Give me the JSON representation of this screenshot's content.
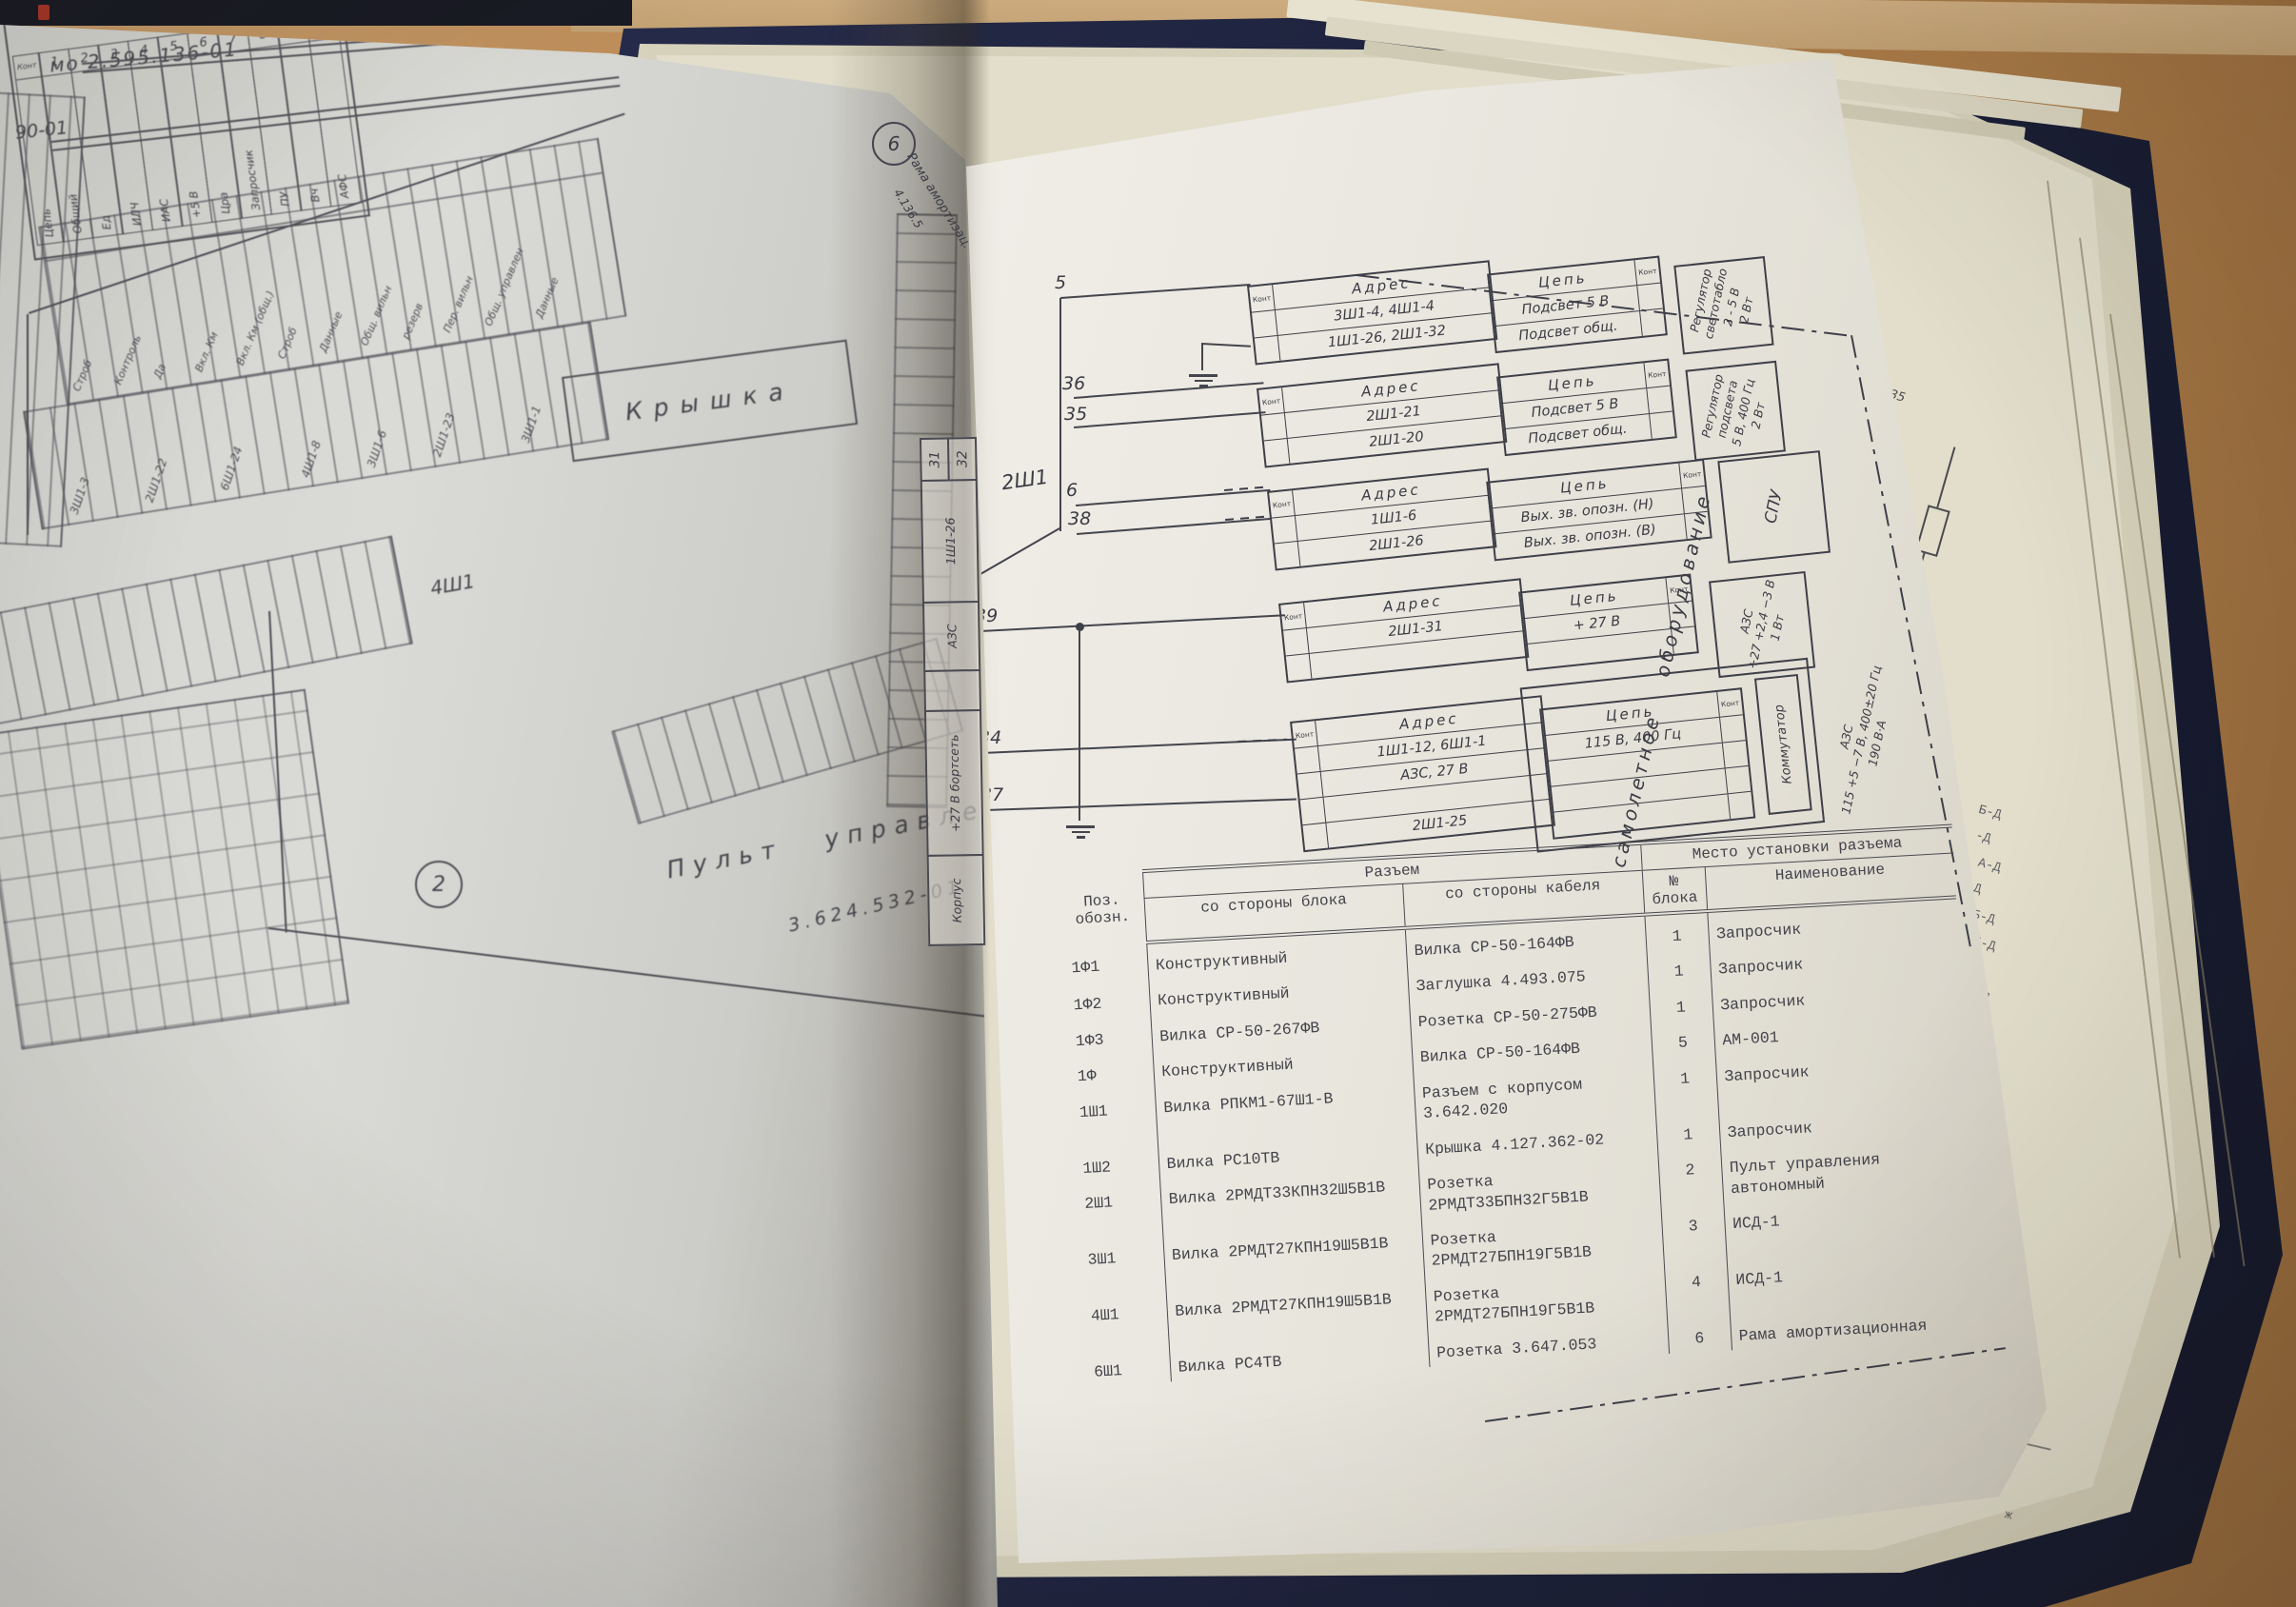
{
  "scene": {
    "description": "Photograph of an open technical manual with wiring schematics and a connector table",
    "colors": {
      "cardboard": "#b5834e",
      "cover": "#1f2440",
      "left_paper": "#d4d5d1",
      "right_paper": "#eae8e0",
      "under_paper": "#e2decb",
      "ink": "#3b3b44"
    }
  },
  "left_page": {
    "doc_number": "мо  2.595.136-01",
    "doc_number2": "90-01",
    "kontrol": {
      "title": "Контроль",
      "connector": "1Ш2",
      "kont": "Конт",
      "tsep": "Цепь",
      "pins": [
        {
          "n": "1",
          "label": "Общий"
        },
        {
          "n": "2",
          "label": "Ед"
        },
        {
          "n": "3",
          "label": "ИЛЧ"
        },
        {
          "n": "4",
          "label": "ИАС"
        },
        {
          "n": "5",
          "label": "+5 В"
        },
        {
          "n": "6",
          "label": "Цра"
        },
        {
          "n": "7",
          "label": "Запросчик"
        },
        {
          "n": "8",
          "label": "ПУ"
        },
        {
          "n": "9",
          "label": "Вч"
        },
        {
          "n": "10",
          "label": "АФС"
        }
      ]
    },
    "kryshka": "Крышка",
    "connector_4sh1": "4Ш1",
    "strip_labels": [
      "Строб",
      "Контроль",
      "Да",
      "Вкл. Км",
      "Вкл. Км (общ.)",
      "Строб",
      "Данные",
      "Общ. вильн",
      "резерв",
      "Пер. вильн",
      "Общ. управлен",
      "Данные"
    ],
    "strip_addresses": [
      "3Ш1-3",
      "2Ш1-22",
      "6Ш1-24",
      "4Ш1-8",
      "3Ш1-6",
      "2Ш1-23",
      "3Ш1-1"
    ],
    "callout_2": "2",
    "pult_title": "Пульт управления автономный",
    "pult_number": "3.624.532-01",
    "callout_6": "6",
    "rama_label": "Рама амортизац.",
    "rama_number": "4.136.5",
    "gutter_connector": {
      "name": "2Ш1",
      "pin_a": "31",
      "pin_b": "32",
      "cells": [
        "1Ш1-26",
        "АЗС",
        "+27 В бортсеть",
        "Корпус"
      ]
    }
  },
  "right_page": {
    "wire_labels": {
      "w5": "5",
      "w36": "36",
      "w35": "35",
      "w6": "6",
      "w38": "38",
      "w39": "39",
      "w34": "34",
      "w37": "37"
    },
    "blocks": [
      {
        "kont": "Конт",
        "adres": "Адрес",
        "tsep": "Цепь",
        "rows": [
          [
            "3Ш1-4, 4Ш1-4",
            "Подсвет 5 В"
          ],
          [
            "1Ш1-26, 2Ш1-32",
            "Подсвет общ."
          ]
        ],
        "equipment": [
          "Регулятор",
          "светотабло",
          "2 - 5 В",
          "2 Вт"
        ]
      },
      {
        "kont": "Конт",
        "adres": "Адрес",
        "tsep": "Цепь",
        "rows": [
          [
            "2Ш1-21",
            "Подсвет 5 В"
          ],
          [
            "2Ш1-20",
            "Подсвет общ."
          ]
        ],
        "equipment": [
          "Регулятор",
          "подсвета",
          "5 В, 400 Гц",
          "2 Вт"
        ]
      },
      {
        "kont": "Конт",
        "adres": "Адрес",
        "tsep": "Цепь",
        "rows": [
          [
            "1Ш1-6",
            "Вых. зв. опозн. (Н)"
          ],
          [
            "2Ш1-26",
            "Вых. зв. опозн. (В)"
          ]
        ],
        "equipment": [
          "СПУ"
        ]
      },
      {
        "kont": "Конт",
        "adres": "Адрес",
        "tsep": "Цепь",
        "rows": [
          [
            "2Ш1-31",
            "+ 27 В"
          ]
        ],
        "equipment": [
          "АЗС",
          "+27 +2,4 −3 В",
          "1 Вт"
        ]
      },
      {
        "kont": "Конт",
        "adres": "Адрес",
        "tsep": "Цепь",
        "rows": [
          [
            "1Ш1-12, 6Ш1-1",
            "115 В, 400 Гц"
          ],
          [
            "АЗС,  27 В",
            ""
          ],
          [
            "2Ш1-25",
            ""
          ]
        ],
        "equipment": [
          "Коммутатор"
        ],
        "equipment2": [
          "АЗС",
          "115 +5 −7 В, 400±20 Гц",
          "190 В·А"
        ]
      }
    ],
    "boundary_label": "самолетное  оборудование",
    "table": {
      "h_pos": "Поз. обозн.",
      "h_razem": "Разъем",
      "h_block_side": "со стороны блока",
      "h_cable_side": "со стороны кабеля",
      "h_place": "Место установки разъема",
      "h_block_no": "№ блока",
      "h_name": "Наименование",
      "rows": [
        {
          "pos": "1Ф1",
          "block": "Конструктивный",
          "cable": "Вилка СР-50-164ФВ",
          "no": "1",
          "name": "Запросчик"
        },
        {
          "pos": "1Ф2",
          "block": "Конструктивный",
          "cable": "Заглушка 4.493.075",
          "no": "1",
          "name": "Запросчик"
        },
        {
          "pos": "1Ф3",
          "block": "Вилка СР-50-267ФВ",
          "cable": "Розетка СР-50-275ФВ",
          "no": "1",
          "name": "Запросчик"
        },
        {
          "pos": "1Ф",
          "block": "Конструктивный",
          "cable": "Вилка СР-50-164ФВ",
          "no": "5",
          "name": "АМ-001"
        },
        {
          "pos": "1Ш1",
          "block": "Вилка РПКМ1-67Ш1-В",
          "cable": "Разъем с корпусом 3.642.020",
          "no": "1",
          "name": "Запросчик"
        },
        {
          "pos": "1Ш2",
          "block": "Вилка РС10ТВ",
          "cable": "Крышка 4.127.362-02",
          "no": "1",
          "name": "Запросчик"
        },
        {
          "pos": "2Ш1",
          "block": "Вилка 2РМДТ33КПН32Ш5В1В",
          "cable": "Розетка 2РМДТ33БПН32Г5В1В",
          "no": "2",
          "name": "Пульт управления автономный"
        },
        {
          "pos": "3Ш1",
          "block": "Вилка 2РМДТ27КПН19Ш5В1В",
          "cable": "Розетка 2РМДТ27БПН19Г5В1В",
          "no": "3",
          "name": "ИСД-1"
        },
        {
          "pos": "4Ш1",
          "block": "Вилка 2РМДТ27КПН19Ш5В1В",
          "cable": "Розетка 2РМДТ27БПН19Г5В1В",
          "no": "4",
          "name": "ИСД-1"
        },
        {
          "pos": "6Ш1",
          "block": "Вилка РС4ТВ",
          "cable": "Розетка 3.647.053",
          "no": "6",
          "name": "Рама амортизационная"
        }
      ],
      "margin_marks": [
        "ж",
        "ж",
        "-в"
      ]
    }
  },
  "under_page": {
    "r35": "R35",
    "v23": "V23",
    "r36": "R36",
    "pin4": "4",
    "pin3": "3",
    "fragments": [
      "Б-Д",
      "-Д",
      "А-Д",
      "-Д",
      "Б-Д",
      "Б-Д",
      "-Д",
      "А-Д"
    ],
    "fragment_sha": "ша",
    "fragment_e": "е",
    "marks": "ж"
  }
}
